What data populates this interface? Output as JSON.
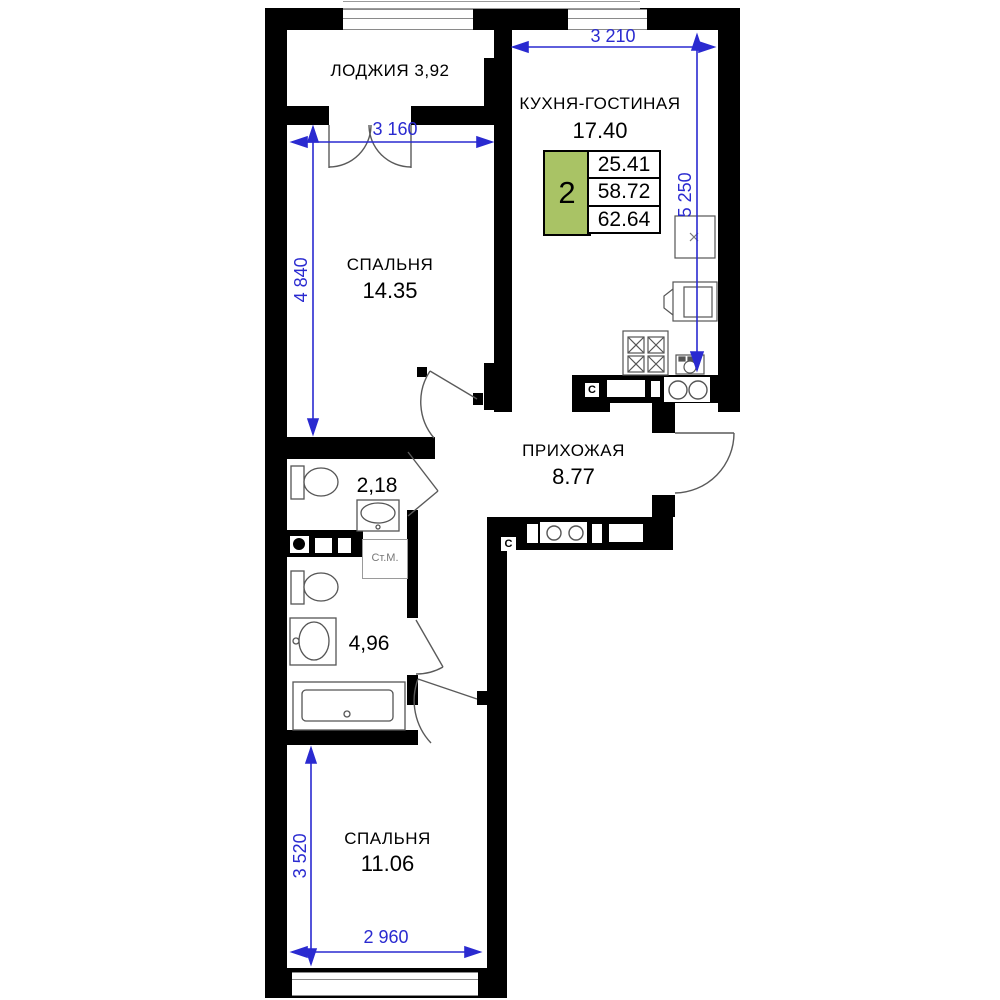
{
  "badge": {
    "rooms_count": "2",
    "values": [
      "25.41",
      "58.72",
      "62.64"
    ]
  },
  "rooms": {
    "loggia": {
      "name": "ЛОДЖИЯ",
      "area": "3,92"
    },
    "kitchen_living": {
      "name": "КУХНЯ-ГОСТИНАЯ",
      "area": "17.40"
    },
    "bedroom_top": {
      "name": "СПАЛЬНЯ",
      "area": "14.35"
    },
    "hallway": {
      "name": "ПРИХОЖАЯ",
      "area": "8.77"
    },
    "wc_small": {
      "area": "2,18"
    },
    "bathroom": {
      "area": "4,96"
    },
    "bedroom_bottom": {
      "name": "СПАЛЬНЯ",
      "area": "11.06"
    }
  },
  "dimensions": {
    "kitchen_width": "3 210",
    "kitchen_depth": "5 250",
    "bedroom_top_width": "3 160",
    "bedroom_top_depth": "4 840",
    "bedroom_bottom_depth": "3 520",
    "bedroom_bottom_width": "2 960"
  },
  "labels": {
    "washing_machine": "Ст.М.",
    "vent_kitchen": "C",
    "vent_hall": "C"
  },
  "colors": {
    "wall": "#000000",
    "dimension_blue": "#2a2ad0",
    "badge_green": "#a9c365"
  }
}
